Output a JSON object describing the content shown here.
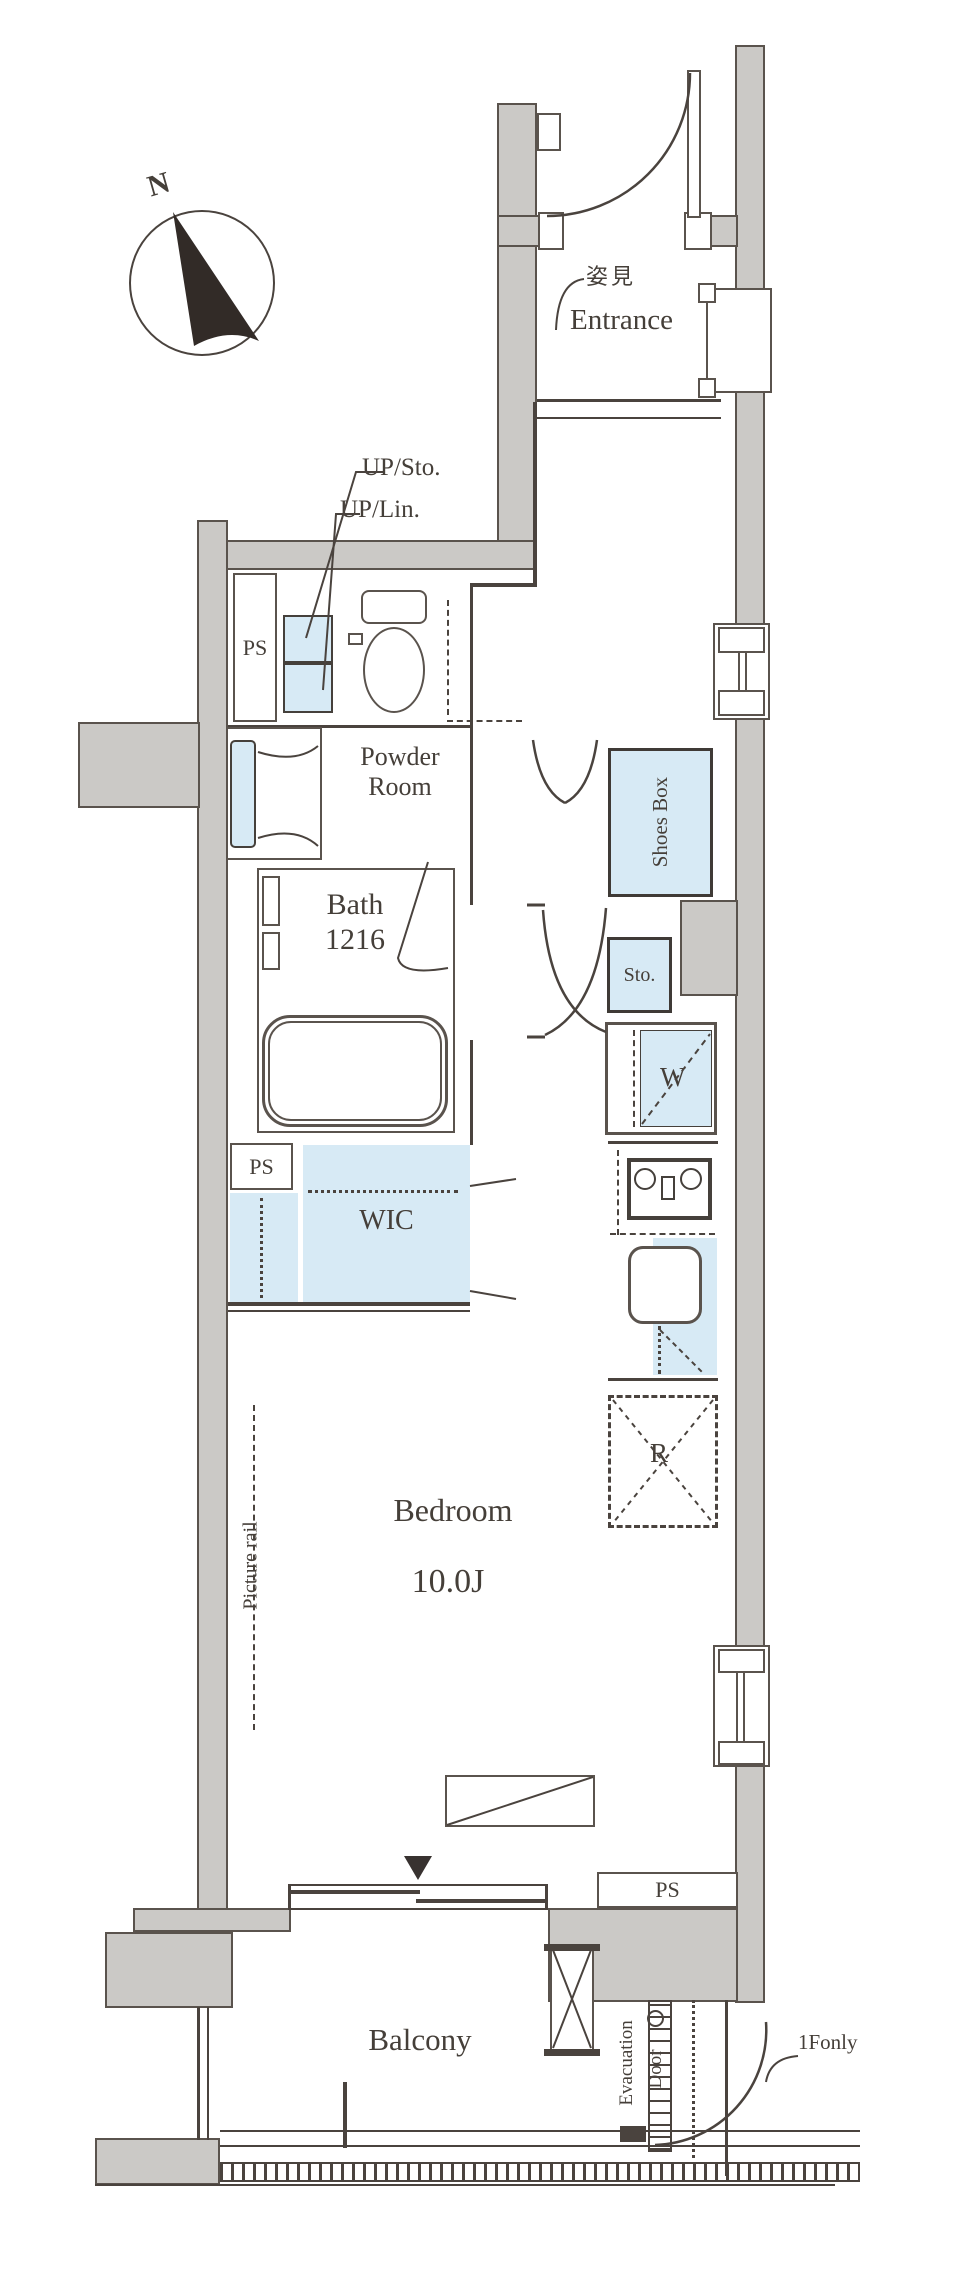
{
  "compass": {
    "north_label": "N"
  },
  "rooms": {
    "entrance": {
      "label": "Entrance",
      "mirror_label": "姿見"
    },
    "powder_room": {
      "line1": "Powder",
      "line2": "Room"
    },
    "bath": {
      "label": "Bath",
      "size": "1216"
    },
    "wic": {
      "label": "WIC"
    },
    "bedroom": {
      "label": "Bedroom",
      "size": "10.0J"
    },
    "balcony": {
      "label": "Balcony"
    }
  },
  "fixtures": {
    "shoes_box": "Shoes Box",
    "storage": "Sto.",
    "washer": "W",
    "refrigerator": "R",
    "up_storage": "UP/Sto.",
    "up_linen": "UP/Lin."
  },
  "annotations": {
    "pipe_space": "PS",
    "picture_rail": "Picture rail",
    "evacuation_line1": "Evacuation",
    "evacuation_line2": "Door",
    "first_floor_only": "1Fonly"
  },
  "colors": {
    "wall_fill": "#cbc9c6",
    "fixture_fill": "#d7eaf5",
    "line": "#4a433e"
  }
}
